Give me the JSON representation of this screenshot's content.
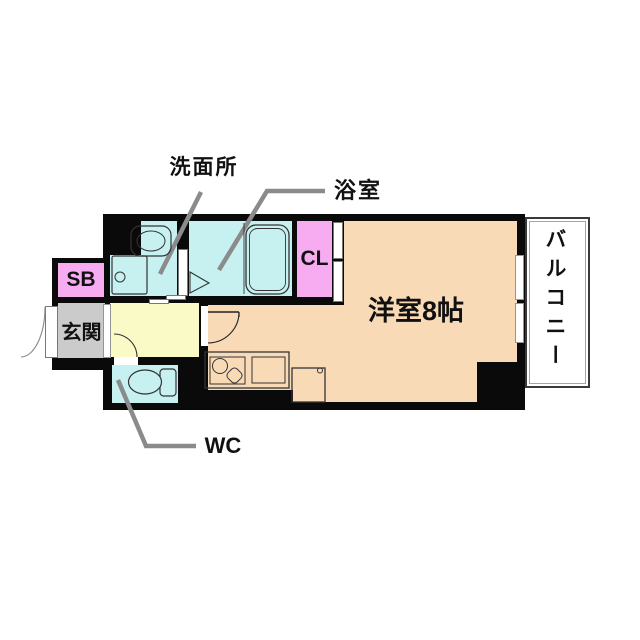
{
  "floorplan": {
    "labels": {
      "washroom": "洗面所",
      "bathroom": "浴室",
      "closet": "CL",
      "shoe_box": "SB",
      "entrance": "玄関",
      "toilet": "WC",
      "main_room": "洋室8帖",
      "balcony": "バルコニー"
    },
    "colors": {
      "wall": "#0a0a0a",
      "wet_area_cyan": "#c7f1f1",
      "closet_pink": "#f7abf0",
      "room_peach": "#f9dab7",
      "hallway_yellow": "#fafac6",
      "entrance_gray": "#cbcbcb",
      "leader_line_gray": "#8b8b8b",
      "background": "#ffffff"
    }
  }
}
